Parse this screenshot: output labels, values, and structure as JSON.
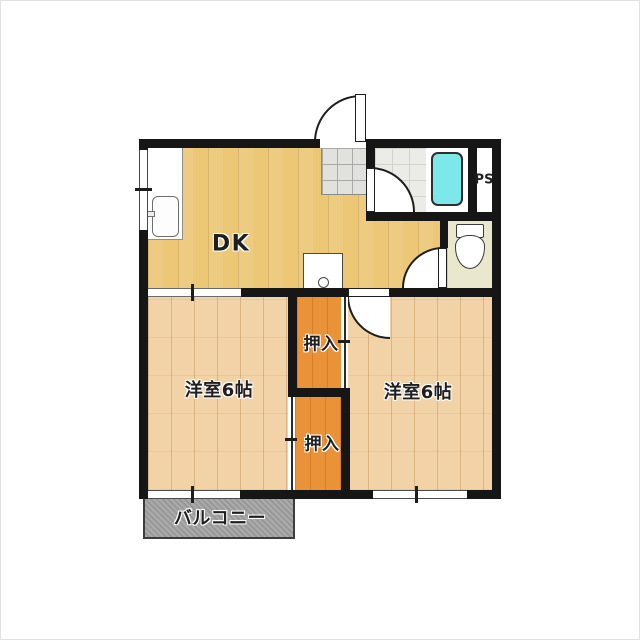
{
  "floorplan": {
    "rooms": [
      {
        "name": "dining-kitchen",
        "label": "DK"
      },
      {
        "name": "bedroom-left",
        "label": "洋室6帖"
      },
      {
        "name": "bedroom-right",
        "label": "洋室6帖"
      },
      {
        "name": "closet-upper",
        "label": "押入"
      },
      {
        "name": "closet-lower",
        "label": "押入"
      },
      {
        "name": "balcony",
        "label": "バルコニー"
      },
      {
        "name": "pipe-space",
        "label": "PS"
      }
    ],
    "fixtures": [
      "kitchen-sink",
      "faucet",
      "washing-machine-pan",
      "bathtub",
      "toilet"
    ],
    "doors": [
      "entrance-door",
      "bathroom-door",
      "toilet-door",
      "bedroom-right-door",
      "bedroom-left-sliding-door",
      "closet-upper-sliding-door",
      "closet-lower-sliding-door"
    ],
    "colors": {
      "wall": "#161616",
      "dk_floor": "#ecc876",
      "bedroom_floor": "#f2d3a7",
      "closet_floor": "#ea9238",
      "genkan_tile": "#e1e1dd",
      "bath_floor": "#ebebe7",
      "toilet_floor": "#e9e7cc",
      "balcony": "#9c9c9c",
      "bathtub": "#7ce8e9",
      "background": "#ffffff"
    }
  }
}
